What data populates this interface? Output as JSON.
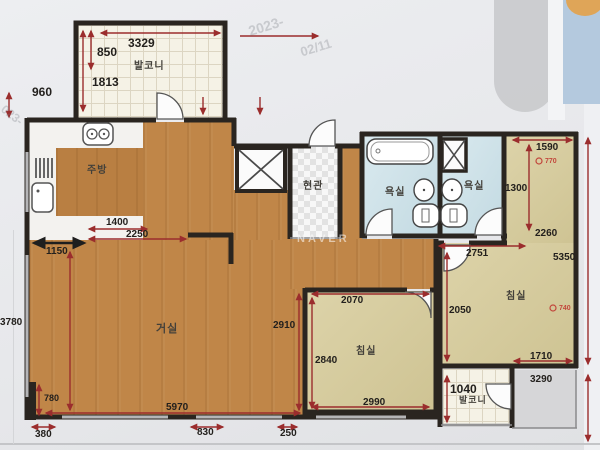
{
  "photo": {
    "naver_watermark": "NAVER",
    "stamp_top_1": "2023-",
    "stamp_top_2": "02/11",
    "stamp_left": "023-",
    "colors": {
      "wood_floor": "#c08648",
      "bedroom_floor": "#d8cd9d",
      "bathroom_floor": "#cde2e9",
      "dimension_arrow": "#9b2d2d",
      "wall": "#2a2520"
    }
  },
  "rooms": {
    "balcony_top": "발코니",
    "kitchen": "주방",
    "living": "거실",
    "entrance": "현관",
    "bath_left": "욕실",
    "bath_right": "욕실",
    "bedroom_mid": "침실",
    "bedroom_right": "침실",
    "balcony_bottom": "발코니"
  },
  "dims": {
    "balcony_top_width": "3329",
    "balcony_top_h1": "850",
    "balcony_top_h2": "1813",
    "left_step": "960",
    "kitchen_w1": "1400",
    "kitchen_w2": "2250",
    "kitchen_w3": "1150",
    "living_left_height": "3780",
    "living_nook": "780",
    "living_width": "5970",
    "bottom_a": "380",
    "bottom_b": "830",
    "bottom_c": "250",
    "living_right_height": "2910",
    "bed_mid_top": "2070",
    "bed_mid_left": "2840",
    "bed_mid_bottom": "2990",
    "hall_height": "2050",
    "bed_right_lower_width": "2751",
    "bed_right_top": "1590",
    "bed_right_h1": "1300",
    "bed_right_h2": "2260",
    "bed_right_total_h": "5350",
    "bed_right_bottom": "1710",
    "corridor": "3290",
    "balcony_bottom_w": "1040",
    "marker_upper": "770",
    "marker_lower": "740"
  }
}
